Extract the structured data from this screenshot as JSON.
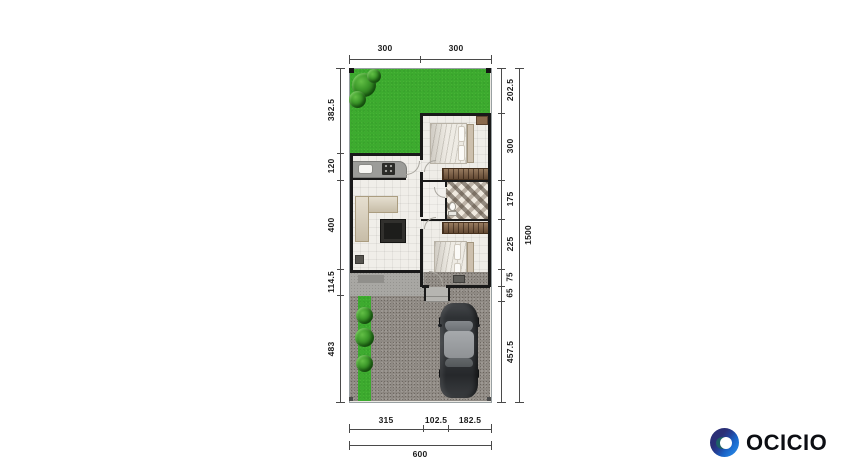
{
  "plan": {
    "top_dims": [
      "300",
      "300"
    ],
    "left_dims": [
      "382.5",
      "120",
      "400",
      "114.5",
      "483"
    ],
    "right_dims": [
      "202.5",
      "300",
      "175",
      "225",
      "75",
      "65",
      "457.5"
    ],
    "overall_height": "1500",
    "bottom_dims": [
      "315",
      "102.5",
      "182.5"
    ],
    "overall_width": "600"
  },
  "logo": {
    "text": "OCICIO",
    "icon": "ocicio-ring-icon",
    "navy": "#2a3078",
    "blue": "#1a6ad1",
    "light_blue": "#2f8ce4",
    "teal": "#1d5f66",
    "text_color": "#0c0e13"
  },
  "colors": {
    "grass": "#3dab2f",
    "gravel": "#8f8a84",
    "wall": "#191919",
    "dimension": "#4a4a4a",
    "terrace": "#a8a7a3",
    "sofa": "#d8cdb6",
    "wardrobe": "#74563c",
    "car_body": "#34373a",
    "car_roof": "#a2a5a8"
  }
}
